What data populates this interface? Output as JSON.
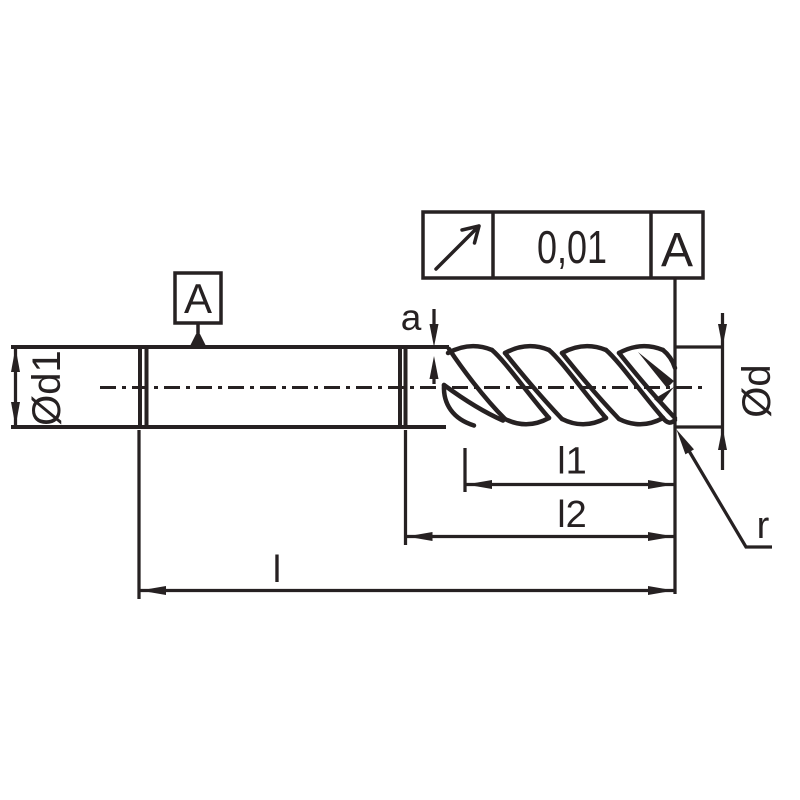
{
  "drawing": {
    "colors": {
      "line": "#262122",
      "background": "#ffffff"
    },
    "tolerance_frame": {
      "symbol": "circular-runout",
      "value": "0,01",
      "datum": "A"
    },
    "datum_flag": {
      "label": "A"
    },
    "labels": {
      "shank_diameter": "Ød1",
      "cutting_diameter": "Ød",
      "relief_depth": "a",
      "flute_length": "l1",
      "reach_length": "l2",
      "overall_length": "l",
      "corner_radius": "r"
    }
  }
}
